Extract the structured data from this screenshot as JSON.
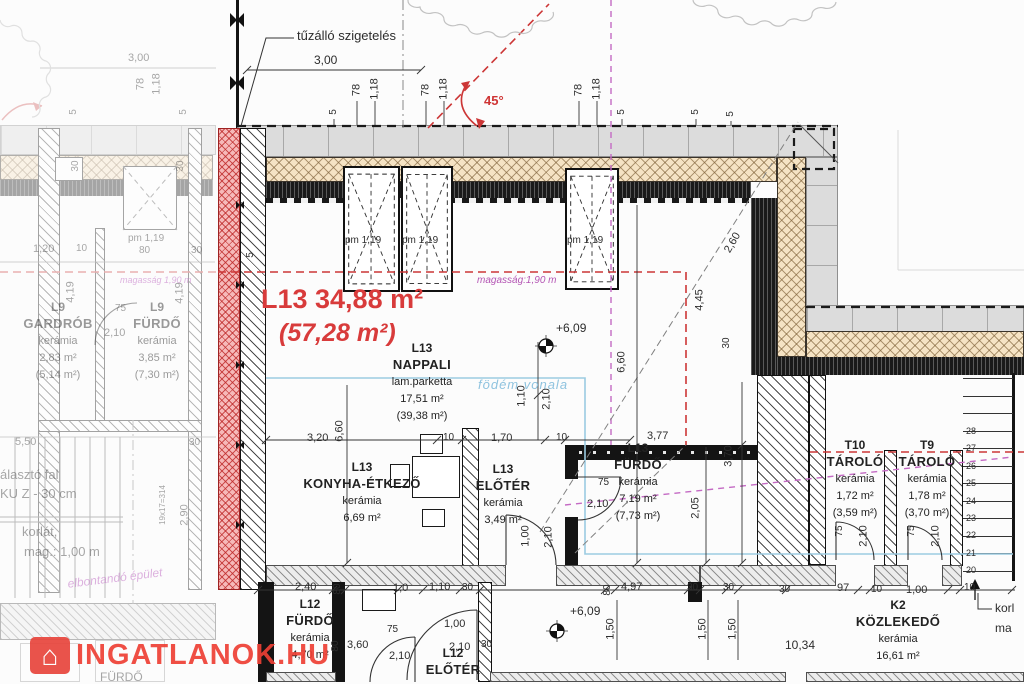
{
  "watermark": {
    "text": "INGATLANOK.HU",
    "icon": "house-icon"
  },
  "headline": {
    "line1": "L13 34,88 m²",
    "line2": "(57,28 m²)"
  },
  "colors": {
    "accent_red": "#d83b3b",
    "magenta": "#b455b4",
    "cyan": "#8fc3df",
    "insulation_tan": "#f5e3c4",
    "fire_strip": "#f6b9b9",
    "watermark_red": "#ee4035"
  },
  "rooms": [
    {
      "id": "L13",
      "name": "NAPPALI",
      "floor": "lam.parketta",
      "area": "17,51 m²",
      "gross": "(39,38 m²)",
      "cx": 422,
      "y": 340
    },
    {
      "id": "L13",
      "name": "KONYHA-ÉTKEZŐ",
      "floor": "kerámia",
      "area": "6,69 m²",
      "cx": 362,
      "y": 459
    },
    {
      "id": "L13",
      "name": "ELŐTÉR",
      "floor": "kerámia",
      "area": "3,49 m²",
      "cx": 503,
      "y": 461
    },
    {
      "id": "L13",
      "name": "FÜRDŐ",
      "floor": "kerámia",
      "area": "7,19 m²",
      "gross": "(7,73 m²)",
      "cx": 638,
      "y": 440
    },
    {
      "id": "T10",
      "name": "TÁROLÓ",
      "floor": "kerámia",
      "area": "1,72 m²",
      "gross": "(3,59 m²)",
      "cx": 855,
      "y": 437
    },
    {
      "id": "T9",
      "name": "TÁROLÓ",
      "floor": "kerámia",
      "area": "1,78 m²",
      "gross": "(3,70 m²)",
      "cx": 927,
      "y": 437
    },
    {
      "id": "K2",
      "name": "KÖZLEKEDŐ",
      "floor": "kerámia",
      "area": "16,61 m²",
      "cx": 898,
      "y": 597
    },
    {
      "id": "L12",
      "name": "FÜRDŐ",
      "floor": "kerámia",
      "area": "4,70 m²",
      "cx": 310,
      "y": 596
    },
    {
      "id": "L12",
      "name": "ELŐTÉR",
      "cx": 453,
      "y": 645
    },
    {
      "id": "L9",
      "name": "GARDRÓB",
      "floor": "kerámia",
      "area": "2,83 m²",
      "gross": "(5,14 m²)",
      "cx": 58,
      "y": 299,
      "cls": "fadedL"
    },
    {
      "id": "L9",
      "name": "FÜRDŐ",
      "floor": "kerámia",
      "area": "3,85 m²",
      "gross": "(7,30 m²)",
      "cx": 157,
      "y": 299,
      "cls": "fadedL"
    }
  ],
  "stairs": {
    "numbers": [
      "28",
      "27",
      "26",
      "25",
      "24",
      "23",
      "22",
      "21",
      "20"
    ]
  },
  "labels": [
    {
      "t": "tűzálló szigetelés",
      "x": 297,
      "y": 29,
      "fs": 13,
      "n": "fire-insulation-label"
    },
    {
      "t": "3,00",
      "x": 314,
      "y": 54,
      "fs": 12
    },
    {
      "t": "78",
      "x": 357,
      "y": 90,
      "r": -90
    },
    {
      "t": "1,18",
      "x": 375,
      "y": 89,
      "r": -90
    },
    {
      "t": "78",
      "x": 426,
      "y": 90,
      "r": -90
    },
    {
      "t": "1,18",
      "x": 444,
      "y": 89,
      "r": -90
    },
    {
      "t": "78",
      "x": 579,
      "y": 90,
      "r": -90
    },
    {
      "t": "1,18",
      "x": 597,
      "y": 89,
      "r": -90
    },
    {
      "t": "5",
      "x": 334,
      "y": 112,
      "r": -90,
      "fs": 10
    },
    {
      "t": "5",
      "x": 622,
      "y": 112,
      "r": -90,
      "fs": 10
    },
    {
      "t": "5",
      "x": 696,
      "y": 112,
      "r": -90,
      "fs": 10
    },
    {
      "t": "5",
      "x": 731,
      "y": 114,
      "r": -90,
      "fs": 10
    },
    {
      "t": "45°",
      "x": 484,
      "y": 94,
      "cls": "red",
      "fs": 13,
      "n": "angle-label"
    },
    {
      "t": "5",
      "x": 251,
      "y": 255,
      "r": -90,
      "fs": 10
    },
    {
      "t": "magasság:1,90 m",
      "x": 477,
      "y": 276,
      "cls": "magenta",
      "fs": 10,
      "n": "height-line-label"
    },
    {
      "t": "+6,09",
      "x": 556,
      "y": 322,
      "fs": 12,
      "n": "level-label"
    },
    {
      "t": "pm 1,19",
      "x": 345,
      "y": 236,
      "fs": 10,
      "n": "skylight-label"
    },
    {
      "t": "pm 1,19",
      "x": 402,
      "y": 236,
      "fs": 10,
      "n": "skylight-label"
    },
    {
      "t": "pm 1,19",
      "x": 567,
      "y": 236,
      "fs": 10,
      "n": "skylight-label"
    },
    {
      "t": "födém vonala",
      "x": 478,
      "y": 378,
      "cls": "cyan",
      "fs": 13,
      "n": "slab-line-label"
    },
    {
      "t": "1,10",
      "x": 522,
      "y": 396,
      "r": -90
    },
    {
      "t": "2,10",
      "x": 547,
      "y": 399,
      "r": -90
    },
    {
      "t": "6,60",
      "x": 622,
      "y": 362,
      "r": -90
    },
    {
      "t": "2,60",
      "x": 733,
      "y": 243,
      "r": -60
    },
    {
      "t": "4,45",
      "x": 700,
      "y": 300,
      "r": -90
    },
    {
      "t": "30",
      "x": 727,
      "y": 343,
      "r": -90,
      "fs": 10
    },
    {
      "t": "3,77",
      "x": 647,
      "y": 431
    },
    {
      "t": "3,70",
      "x": 729,
      "y": 456,
      "r": -90
    },
    {
      "t": "2,05",
      "x": 696,
      "y": 508,
      "r": -90
    },
    {
      "t": "6,60",
      "x": 340,
      "y": 431,
      "r": -90
    },
    {
      "t": "3,20",
      "x": 307,
      "y": 433
    },
    {
      "t": "10",
      "x": 443,
      "y": 433,
      "fs": 10
    },
    {
      "t": "1,70",
      "x": 491,
      "y": 433
    },
    {
      "t": "10",
      "x": 556,
      "y": 433,
      "fs": 10
    },
    {
      "t": "1,00",
      "x": 526,
      "y": 536,
      "r": -90
    },
    {
      "t": "2,10",
      "x": 549,
      "y": 537,
      "r": -90
    },
    {
      "t": "75",
      "x": 598,
      "y": 478,
      "fs": 10
    },
    {
      "t": "2,10",
      "x": 587,
      "y": 499
    },
    {
      "t": "75",
      "x": 840,
      "y": 531,
      "r": -90,
      "fs": 10
    },
    {
      "t": "2,10",
      "x": 864,
      "y": 536,
      "r": -90
    },
    {
      "t": "75",
      "x": 912,
      "y": 531,
      "r": -90,
      "fs": 10
    },
    {
      "t": "2,10",
      "x": 936,
      "y": 536,
      "r": -90
    },
    {
      "t": "2,40",
      "x": 295,
      "y": 582
    },
    {
      "t": "80",
      "x": 338,
      "y": 589,
      "r": -90,
      "fs": 10
    },
    {
      "t": "1,0",
      "x": 393,
      "y": 583
    },
    {
      "t": "1,10",
      "x": 429,
      "y": 582
    },
    {
      "t": "30",
      "x": 462,
      "y": 583,
      "fs": 10
    },
    {
      "t": "80",
      "x": 608,
      "y": 590,
      "r": -90,
      "fs": 10
    },
    {
      "t": "4,97",
      "x": 621,
      "y": 582
    },
    {
      "t": "30",
      "x": 687,
      "y": 583,
      "fs": 10
    },
    {
      "t": "30",
      "x": 723,
      "y": 583,
      "fs": 10
    },
    {
      "t": "30",
      "x": 779,
      "y": 585,
      "fs": 10
    },
    {
      "t": "97",
      "x": 837,
      "y": 583
    },
    {
      "t": "10",
      "x": 871,
      "y": 585,
      "fs": 10
    },
    {
      "t": "1,00",
      "x": 906,
      "y": 585
    },
    {
      "t": "10",
      "x": 964,
      "y": 583,
      "fs": 10
    },
    {
      "t": "1,50",
      "x": 611,
      "y": 629,
      "r": -90
    },
    {
      "t": "1,50",
      "x": 703,
      "y": 629,
      "r": -90
    },
    {
      "t": "1,50",
      "x": 733,
      "y": 629,
      "r": -90
    },
    {
      "t": "10,34",
      "x": 785,
      "y": 639,
      "fs": 12
    },
    {
      "t": "+6,09",
      "x": 570,
      "y": 605,
      "fs": 12,
      "n": "level-label"
    },
    {
      "t": "75",
      "x": 387,
      "y": 625,
      "fs": 10
    },
    {
      "t": "3,60",
      "x": 347,
      "y": 640
    },
    {
      "t": "2,10",
      "x": 389,
      "y": 651
    },
    {
      "t": "1,00",
      "x": 444,
      "y": 619
    },
    {
      "t": "2,10",
      "x": 449,
      "y": 642
    },
    {
      "t": "30",
      "x": 481,
      "y": 640,
      "fs": 10
    },
    {
      "t": "80",
      "x": 336,
      "y": 646,
      "r": -90,
      "fs": 10
    },
    {
      "t": "korl",
      "x": 995,
      "y": 602,
      "fs": 12,
      "n": "railing-note-cut"
    },
    {
      "t": "ma",
      "x": 995,
      "y": 622,
      "fs": 12,
      "n": "railing-note-cut"
    },
    {
      "t": "19x17=314",
      "x": 163,
      "y": 505,
      "r": -90,
      "fs": 8,
      "cls": "fadedL",
      "n": "stair-note"
    },
    {
      "t": "3,00",
      "x": 128,
      "y": 53,
      "cls": "fadedL"
    },
    {
      "t": "78",
      "x": 141,
      "y": 84,
      "r": -90,
      "cls": "fadedL"
    },
    {
      "t": "1,18",
      "x": 157,
      "y": 84,
      "r": -90,
      "cls": "fadedL"
    },
    {
      "t": "5",
      "x": 74,
      "y": 112,
      "r": -90,
      "fs": 10,
      "cls": "fadedL"
    },
    {
      "t": "5",
      "x": 184,
      "y": 112,
      "r": -90,
      "fs": 10,
      "cls": "fadedL"
    },
    {
      "t": "30",
      "x": 76,
      "y": 166,
      "r": -90,
      "fs": 10,
      "cls": "fadedL"
    },
    {
      "t": "30",
      "x": 181,
      "y": 166,
      "r": -90,
      "fs": 10,
      "cls": "fadedL"
    },
    {
      "t": "pm 1,19",
      "x": 128,
      "y": 234,
      "fs": 10,
      "cls": "fadedL"
    },
    {
      "t": "1,20",
      "x": 33,
      "y": 244,
      "cls": "fadedL"
    },
    {
      "t": "10",
      "x": 76,
      "y": 244,
      "fs": 10,
      "cls": "fadedL"
    },
    {
      "t": "80",
      "x": 139,
      "y": 246,
      "fs": 10,
      "cls": "fadedL"
    },
    {
      "t": "30",
      "x": 191,
      "y": 246,
      "fs": 10,
      "cls": "fadedL"
    },
    {
      "t": "4,19",
      "x": 71,
      "y": 292,
      "r": -90,
      "cls": "fadedL"
    },
    {
      "t": "4,19",
      "x": 180,
      "y": 293,
      "r": -90,
      "cls": "fadedL"
    },
    {
      "t": "75",
      "x": 115,
      "y": 304,
      "fs": 10,
      "cls": "fadedL"
    },
    {
      "t": "2,10",
      "x": 104,
      "y": 328,
      "cls": "fadedL"
    },
    {
      "t": "magasság 1,90 m",
      "x": 120,
      "y": 276,
      "cls": "faded-magenta",
      "fs": 9
    },
    {
      "t": "5,50",
      "x": 15,
      "y": 437,
      "cls": "fadedL"
    },
    {
      "t": "30",
      "x": 189,
      "y": 438,
      "fs": 10,
      "cls": "fadedL"
    },
    {
      "t": "álasztó fal",
      "x": 0,
      "y": 468,
      "fs": 13,
      "cls": "fadedL",
      "n": "wall-note"
    },
    {
      "t": "KU Z - 30 cm",
      "x": 0,
      "y": 487,
      "fs": 13,
      "cls": "fadedL",
      "n": "wall-note"
    },
    {
      "t": "korlát,",
      "x": 22,
      "y": 525,
      "fs": 13,
      "cls": "fadedL",
      "n": "railing-note"
    },
    {
      "t": "mag.: 1,00 m",
      "x": 24,
      "y": 545,
      "fs": 13,
      "cls": "fadedL",
      "n": "railing-note"
    },
    {
      "t": "2,90",
      "x": 185,
      "y": 515,
      "r": -90,
      "cls": "fadedL"
    },
    {
      "t": "elbontandó épület",
      "x": 115,
      "y": 578,
      "r": -7,
      "cls": "faded-magenta",
      "fs": 12,
      "n": "demolish-note"
    },
    {
      "t": "FÜRDŐ",
      "x": 100,
      "y": 671,
      "fs": 12,
      "cls": "fadedL"
    }
  ]
}
